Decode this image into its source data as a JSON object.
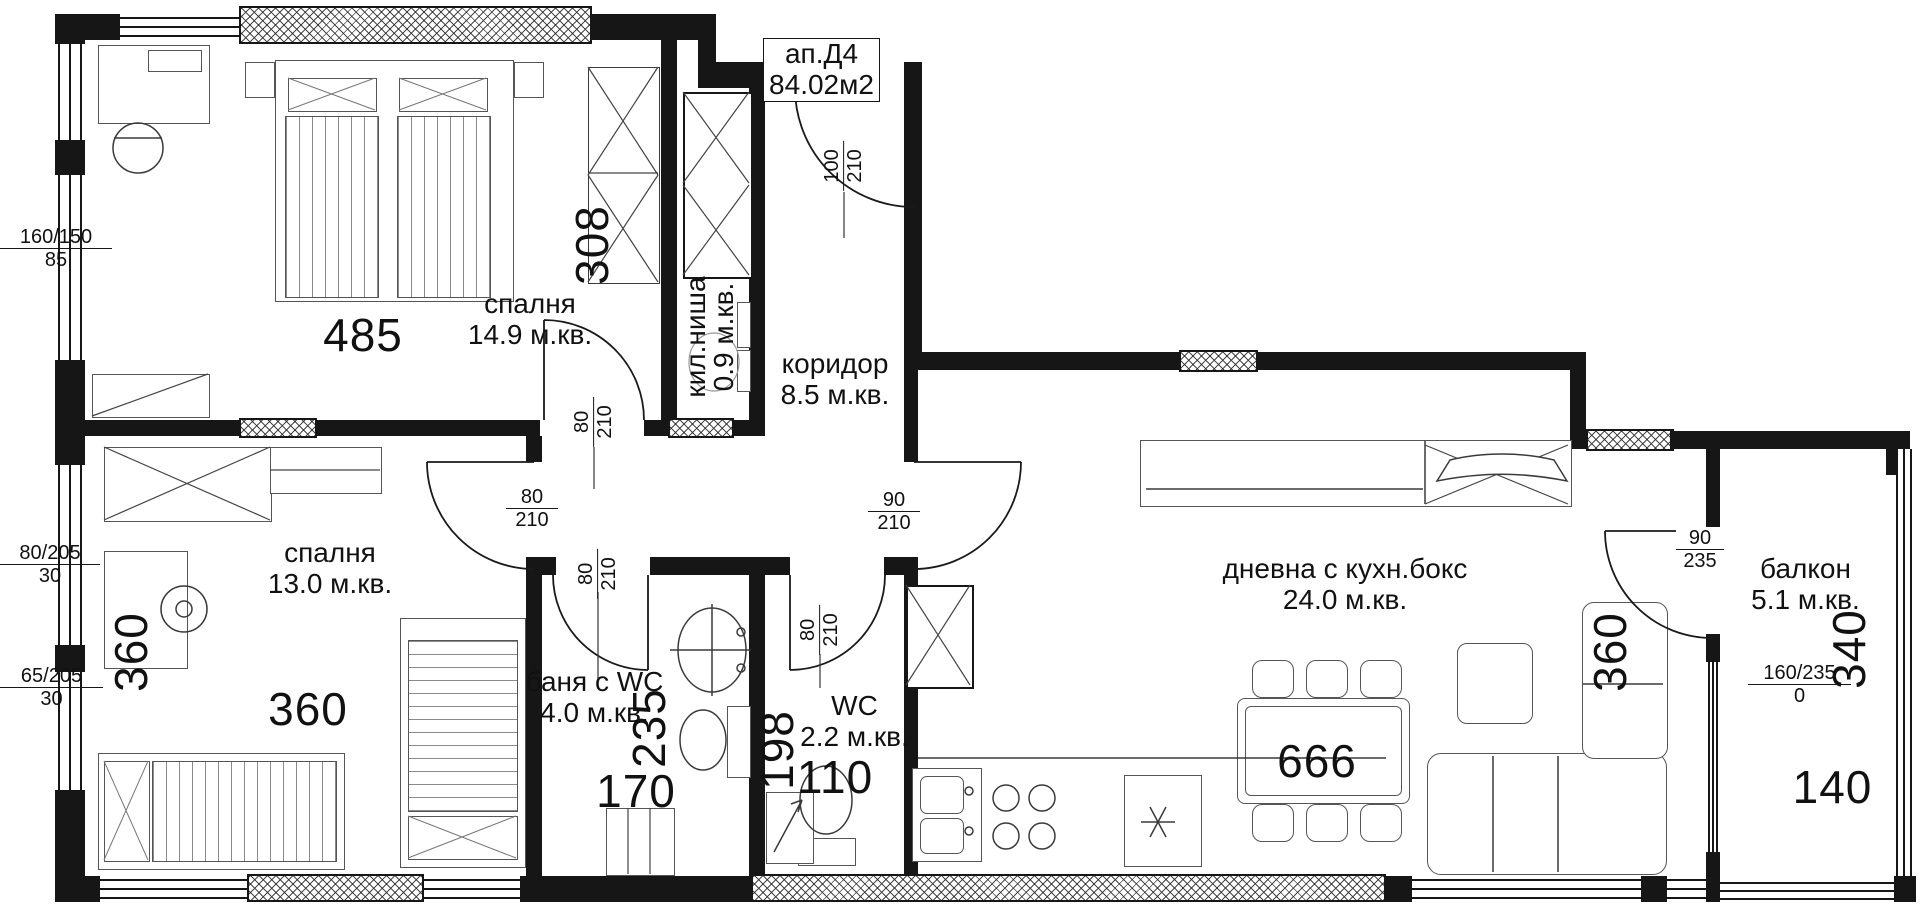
{
  "floorplan": {
    "title": {
      "apartment": "ап.Д4",
      "area": "84.02м2"
    },
    "rooms": {
      "bedroom1": {
        "name": "спалня",
        "area": "14.9 м.кв."
      },
      "closet": {
        "name": "кил.ниша",
        "area": "0.9 м.кв."
      },
      "corridor": {
        "name": "коридор",
        "area": "8.5 м.кв."
      },
      "bedroom2": {
        "name": "спалня",
        "area": "13.0 м.кв."
      },
      "bathroom": {
        "name": "баня с WC",
        "area": "4.0 м.кв."
      },
      "wc": {
        "name": "WC",
        "area": "2.2 м.кв."
      },
      "living": {
        "name": "дневна с кухн.бокс",
        "area": "24.0 м.кв."
      },
      "balcony": {
        "name": "балкон",
        "area": "5.1 м.кв."
      }
    },
    "dimensions": {
      "bedroom1_width": "485",
      "wardrobe_depth": "308",
      "bedroom2_height": "360",
      "bedroom2_width": "360",
      "bath_height": "235",
      "bath_width": "170",
      "wc_height": "198",
      "wc_width": "110",
      "living_width": "666",
      "living_height": "360",
      "balcony_height": "340",
      "balcony_width": "140"
    },
    "doors": {
      "entrance": {
        "width": "100",
        "height": "210"
      },
      "bedroom1": {
        "width": "80",
        "height": "210"
      },
      "bedroom2": {
        "width": "80",
        "height": "210"
      },
      "living": {
        "width": "90",
        "height": "210"
      },
      "bathroom": {
        "width": "80",
        "height": "210"
      },
      "wc": {
        "width": "80",
        "height": "210"
      },
      "balcony": {
        "width": "90",
        "height": "235"
      }
    },
    "windows": {
      "bedroom1": {
        "size": "160/150",
        "sill": "85"
      },
      "bedroom2_a": {
        "size": "80/205",
        "sill": "30"
      },
      "bedroom2_b": {
        "size": "65/205",
        "sill": "30"
      },
      "balcony": {
        "size": "160/235",
        "sill": "0"
      }
    }
  }
}
